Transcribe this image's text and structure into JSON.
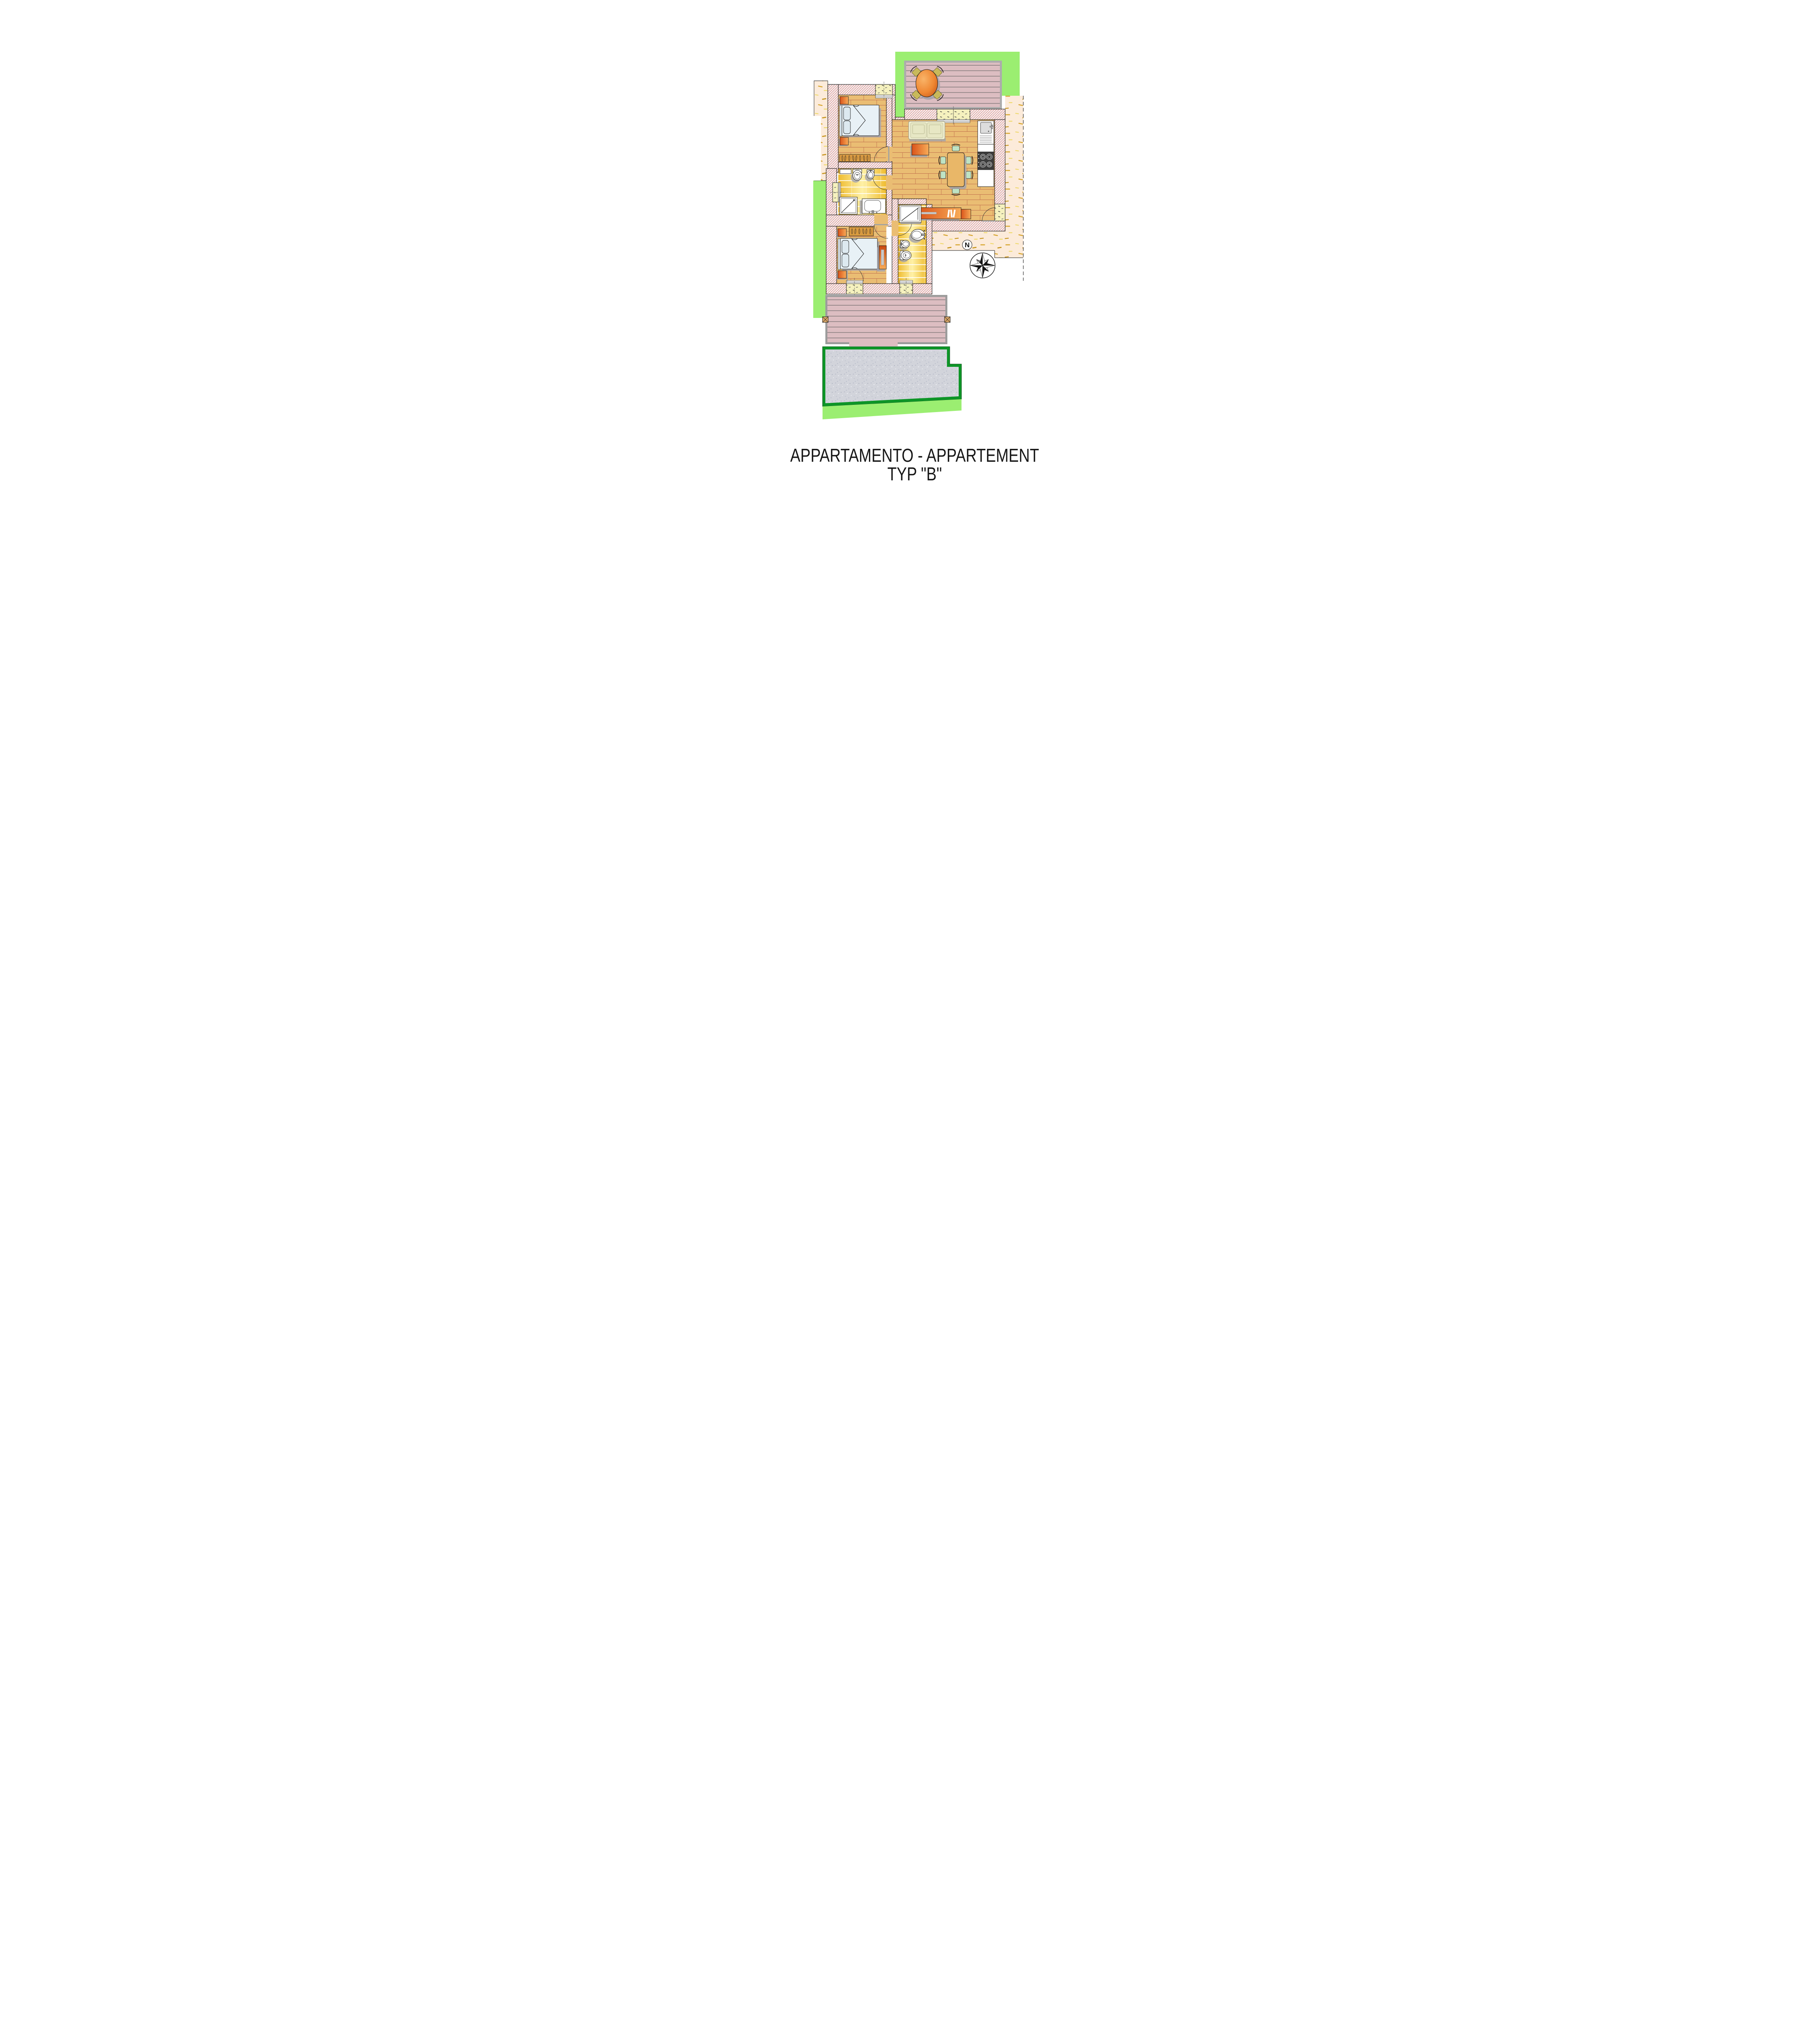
{
  "title": {
    "line1": "APPARTAMENTO - APPARTEMENT",
    "line2": "TYP \"B\""
  },
  "compass": {
    "north_label": "N"
  },
  "plan": {
    "type": "apartment-floor-plan",
    "rooms": [
      {
        "name": "bedroom-1",
        "icons": [
          "double-bed-icon",
          "pillow-icon",
          "nightstand-icon",
          "nightstand-icon",
          "wardrobe-hangers-icon",
          "door-swing-icon",
          "window-icon"
        ]
      },
      {
        "name": "bathroom-1",
        "icons": [
          "toilet-icon",
          "bidet-icon",
          "washbasin-icon",
          "shower-icon",
          "shelf-icon",
          "window-icon",
          "door-swing-icon"
        ]
      },
      {
        "name": "living-kitchen",
        "icons": [
          "sofa-icon",
          "coffee-table-icon",
          "dining-table-icon",
          "chair-icon",
          "kitchen-sink-icon",
          "stove-4-burner-icon",
          "counter-icon",
          "sideboard-icon",
          "books-icon",
          "entry-door-swing-icon",
          "window-icon"
        ]
      },
      {
        "name": "hall",
        "icons": []
      },
      {
        "name": "bedroom-2",
        "icons": [
          "double-bed-icon",
          "pillow-icon",
          "nightstand-icon",
          "nightstand-icon",
          "wardrobe-hangers-icon",
          "dresser-icon",
          "french-door-swing-icon"
        ]
      },
      {
        "name": "bathroom-2",
        "icons": [
          "shower-icon",
          "washbasin-icon",
          "bidet-icon",
          "toilet-icon",
          "window-icon",
          "door-swing-icon"
        ]
      }
    ],
    "outdoor": [
      "lawn",
      "upper-terrace-deck",
      "terrace-round-table",
      "terrace-chairs",
      "sand-plaster-apron",
      "lower-deck",
      "deck-posts",
      "gravel-patio",
      "property-dashed-line",
      "compass-rose"
    ]
  },
  "colors": {
    "lawn": "#9BEE71",
    "lawn_border_dark": "#0D9527",
    "terrace_deck": "#DCBDC1",
    "deck_frame": "#9C9C9C",
    "wall_hatch_red": "#E2654A",
    "wood_floor": "#EABD73",
    "plank_line": "#C2724F",
    "bath_tile_yellow": "#F3C645",
    "furniture_orange_dark": "#E85A1E",
    "furniture_orange_light": "#F8AB57",
    "sofa_cream": "#EFEFD2",
    "chair_mint": "#BFE3C4",
    "bed_linen": "#E8F1F6",
    "sand_apron": "#FCEBDA",
    "sand_dash_gold": "#D7A52C",
    "gravel": "#D2D4DB",
    "window_fill": "#F5F1BE"
  }
}
